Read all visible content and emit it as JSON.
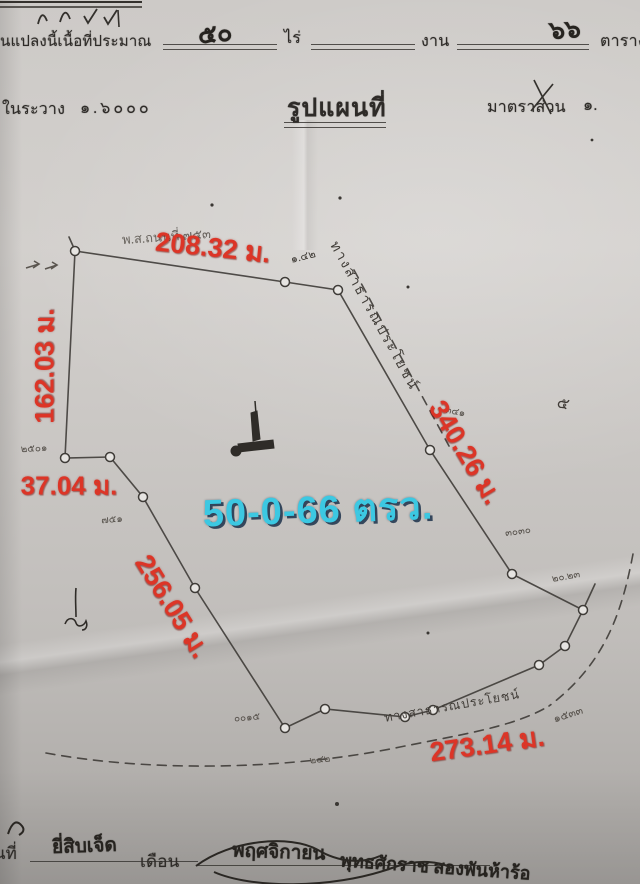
{
  "colors": {
    "measurement_red": "#dc3527",
    "area_cyan": "#3cc8e2",
    "ink": "#35322e",
    "pencil": "#55504a",
    "paper": "#cbc8c5"
  },
  "header": {
    "area_line": {
      "prefix": "นแปลงนี้เนื้อที่ประมาณ",
      "rai_value": "๕๐",
      "rai_unit": "ไร่",
      "ngan_unit": "งาน",
      "wa_value": "๖๖",
      "wa_unit": "ตารางวา"
    },
    "sheet": {
      "label": "ในระวาง",
      "value": "๑.๖๐๐๐"
    },
    "title": "รูปแผนที่",
    "scale": {
      "label": "มาตราส่วน",
      "value": "๑."
    }
  },
  "map": {
    "area_label": "50-0-66 ตรว.",
    "measurements": [
      {
        "side": "top",
        "text": "208.32 ม."
      },
      {
        "side": "left",
        "text": "162.03 ม."
      },
      {
        "side": "left-short",
        "text": "37.04 ม."
      },
      {
        "side": "right",
        "text": "340.26 ม."
      },
      {
        "side": "lower-left",
        "text": "256.05 ม."
      },
      {
        "side": "bottom",
        "text": "273.14 ม."
      }
    ],
    "pencil_notes": [
      {
        "text": "พ.ส.ถนนที่ ๗๕๓"
      },
      {
        "text": "๑.๔๒"
      },
      {
        "text": "ทางสาธารณประโยชน์"
      },
      {
        "text": "๓๔๑"
      },
      {
        "text": "๕"
      },
      {
        "text": "๓๐๓๐"
      },
      {
        "text": "๒๐.๒๓"
      },
      {
        "text": "๑๕๓๓"
      },
      {
        "text": "ทางสาธารณประโยชน์"
      },
      {
        "text": "๐๐๑๕"
      },
      {
        "text": "๗๕๑"
      },
      {
        "text": "๒๕๐๑"
      },
      {
        "text": "๒๔๒"
      }
    ]
  },
  "footer": {
    "date_label": "วันที่",
    "date_value": "ยี่สิบเจ็ด",
    "month_label": "เดือน",
    "month_value": "พฤศจิกายน",
    "era_value": "พุทธศักราช สองพันห้าร้อ"
  }
}
